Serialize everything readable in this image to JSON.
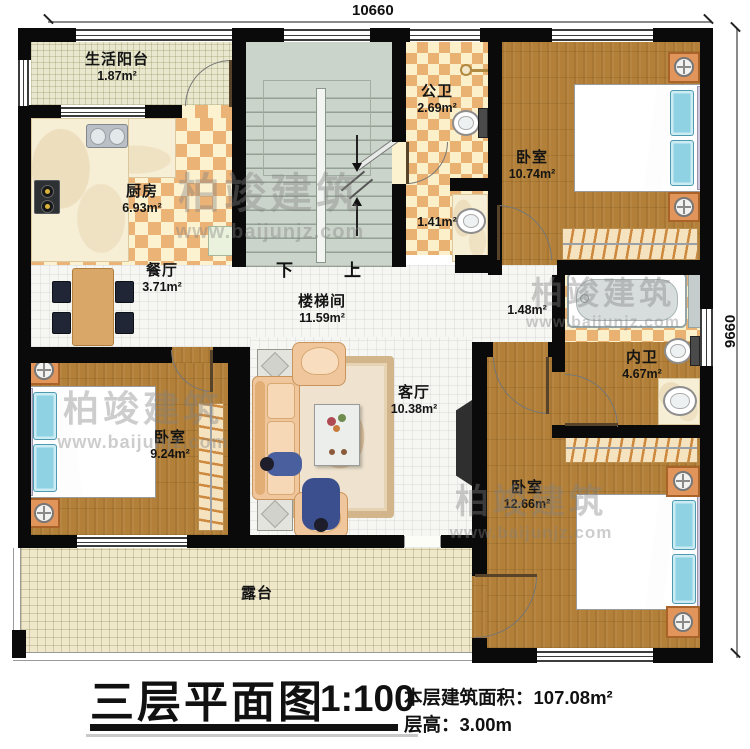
{
  "plan": {
    "dimensions": {
      "top": "10660",
      "right": "9660"
    },
    "stairs": {
      "down": "下",
      "up": "上"
    },
    "rooms": {
      "balcony": {
        "name": "生活阳台",
        "area": "1.87m²"
      },
      "kitchen": {
        "name": "厨房",
        "area": "6.93m²"
      },
      "public_bath": {
        "name": "公卫",
        "area": "2.69m²"
      },
      "washroom": {
        "area": "1.41m²"
      },
      "bedroom_top_right": {
        "name": "卧室",
        "area": "10.74m²"
      },
      "dining": {
        "name": "餐厅",
        "area": "3.71m²"
      },
      "stairwell": {
        "name": "楼梯间",
        "area": "11.59m²"
      },
      "hallway": {
        "area": "1.48m²"
      },
      "bedroom_mid_left": {
        "name": "卧室",
        "area": "9.24m²"
      },
      "living": {
        "name": "客厅",
        "area": "10.38m²"
      },
      "inner_bath": {
        "name": "内卫",
        "area": "4.67m²"
      },
      "bedroom_bottom_right": {
        "name": "卧室",
        "area": "12.66m²"
      },
      "terrace": {
        "name": "露台"
      }
    }
  },
  "watermark": {
    "brand": "柏竣建筑",
    "url": "www.baijunjz.com"
  },
  "title_block": {
    "title": "三层平面图",
    "scale": "1:100",
    "area_label": "本层建筑面积：",
    "area_value": "107.08m²",
    "height_label": "层高：",
    "height_value": "3.00m"
  },
  "colors": {
    "wall": "#0a0a0a",
    "wood_floor": "#b28038",
    "tile_warm": "#ecb377",
    "tile_cream": "#fdf2cf",
    "mattress_blue": "#6fc3dc",
    "stair_green": "#cbd4ca",
    "counter_cream": "#f7eed6"
  }
}
